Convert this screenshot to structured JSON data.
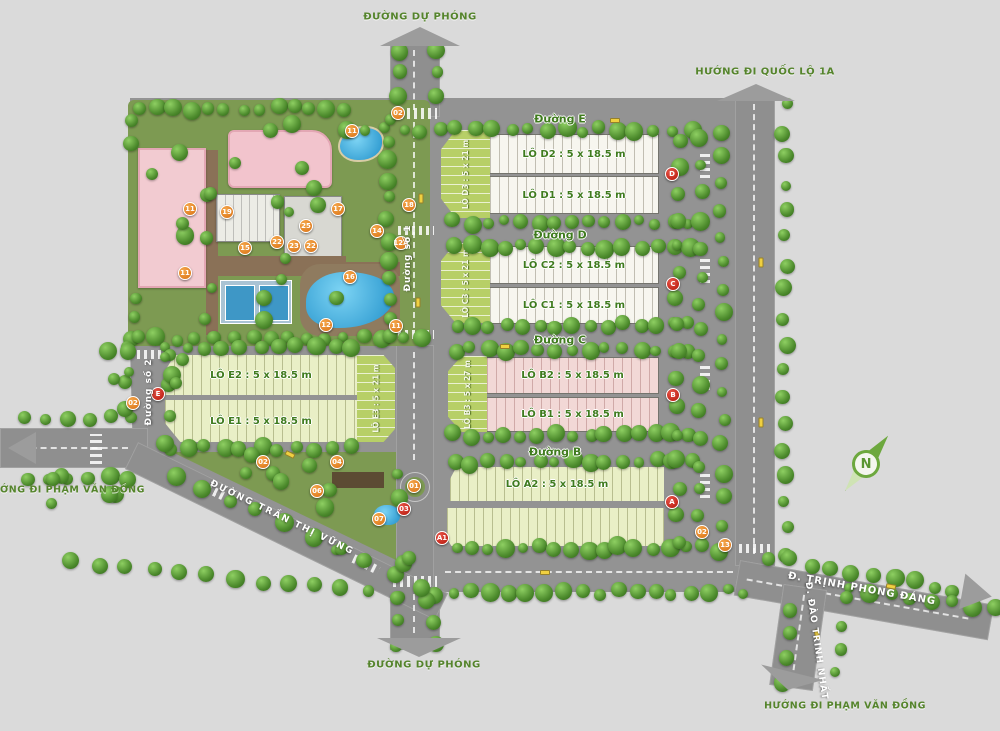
{
  "map": {
    "direction_labels": {
      "top": "ĐƯỜNG DỰ PHÓNG",
      "top_right": "HƯỚNG ĐI QUỐC LỘ 1A",
      "left": "HƯỚNG ĐI PHẠM VĂN ĐỒNG",
      "bottom": "ĐƯỜNG DỰ PHÓNG",
      "bottom_right": "HƯỚNG ĐI PHẠM VĂN ĐỒNG"
    },
    "road_labels": {
      "duong_e": "Đường E",
      "duong_d": "Đường D",
      "duong_c": "Đường C",
      "duong_b": "Đường B",
      "duong_so_1": "Đường số 1",
      "duong_so_2": "Đường số 2",
      "tran_thi_vung": "ĐƯỜNG TRẦN THỊ VỮNG",
      "trinh_phong_dang": "Đ. TRỊNH PHONG ĐÁNG",
      "dao_trinh_nhat": "Đ. ĐÀO TRINH NHẤT"
    },
    "compass_label": "N",
    "blocks": [
      {
        "id": "lo-d2",
        "label": "LÔ D2 : 5 x 18.5 m"
      },
      {
        "id": "lo-d1",
        "label": "LÔ D1 : 5 x 18.5 m"
      },
      {
        "id": "lo-c2",
        "label": "LÔ C2 : 5 x 18.5 m"
      },
      {
        "id": "lo-c1",
        "label": "LÔ C1 : 5 x 18.5 m"
      },
      {
        "id": "lo-b2",
        "label": "LÔ B2 : 5 x 18.5 m"
      },
      {
        "id": "lo-b1",
        "label": "LÔ B1 : 5 x 18.5 m"
      },
      {
        "id": "lo-a2",
        "label": "LÔ A2 : 5 x 18.5 m"
      },
      {
        "id": "lo-e2",
        "label": "LÔ E2 : 5 x 18.5 m"
      },
      {
        "id": "lo-e1",
        "label": "LÔ E1 : 5 x 18.5 m"
      },
      {
        "id": "lo-d3",
        "label": "LÔ D3 : 5 x 21 m"
      },
      {
        "id": "lo-c3",
        "label": "LÔ C3 : 5 x 21 m"
      },
      {
        "id": "lo-b3",
        "label": "LÔ B3 : 5 x 27 m"
      },
      {
        "id": "lo-e3",
        "label": "LÔ E3 : 5 x 21 m"
      }
    ],
    "markers": {
      "orange": [
        {
          "label": "02",
          "x": 398,
          "y": 113
        },
        {
          "label": "18",
          "x": 409,
          "y": 205
        },
        {
          "label": "12A",
          "x": 401,
          "y": 243
        },
        {
          "label": "11",
          "x": 352,
          "y": 131
        },
        {
          "label": "19",
          "x": 227,
          "y": 212
        },
        {
          "label": "11",
          "x": 190,
          "y": 209
        },
        {
          "label": "17",
          "x": 338,
          "y": 209
        },
        {
          "label": "25",
          "x": 306,
          "y": 226
        },
        {
          "label": "14",
          "x": 377,
          "y": 231
        },
        {
          "label": "15",
          "x": 245,
          "y": 248
        },
        {
          "label": "22",
          "x": 277,
          "y": 242
        },
        {
          "label": "23",
          "x": 294,
          "y": 246
        },
        {
          "label": "22",
          "x": 311,
          "y": 246
        },
        {
          "label": "11",
          "x": 185,
          "y": 273
        },
        {
          "label": "16",
          "x": 350,
          "y": 277
        },
        {
          "label": "12",
          "x": 326,
          "y": 325
        },
        {
          "label": "11",
          "x": 396,
          "y": 326
        },
        {
          "label": "02",
          "x": 133,
          "y": 403
        },
        {
          "label": "02",
          "x": 263,
          "y": 462
        },
        {
          "label": "04",
          "x": 337,
          "y": 462
        },
        {
          "label": "06",
          "x": 317,
          "y": 491
        },
        {
          "label": "01",
          "x": 414,
          "y": 486
        },
        {
          "label": "07",
          "x": 379,
          "y": 519
        },
        {
          "label": "02",
          "x": 702,
          "y": 532
        },
        {
          "label": "13",
          "x": 725,
          "y": 545
        }
      ],
      "red": [
        {
          "label": "E",
          "x": 158,
          "y": 394
        },
        {
          "label": "D",
          "x": 672,
          "y": 174
        },
        {
          "label": "C",
          "x": 673,
          "y": 284
        },
        {
          "label": "B",
          "x": 673,
          "y": 395
        },
        {
          "label": "A",
          "x": 672,
          "y": 502
        },
        {
          "label": "A1",
          "x": 442,
          "y": 538
        },
        {
          "label": "03",
          "x": 404,
          "y": 509
        }
      ]
    },
    "colors": {
      "accent_green": "#3f7b1e",
      "marker_orange": "#d86f12",
      "marker_red": "#b31408",
      "road_gray": "#8f8f8f",
      "block_white": "#f7f6ef",
      "block_pink": "#f2d8d6",
      "block_lime": "#e9efc6",
      "strip_green": "#b7cf67",
      "water_blue": "#35a7dd"
    }
  }
}
